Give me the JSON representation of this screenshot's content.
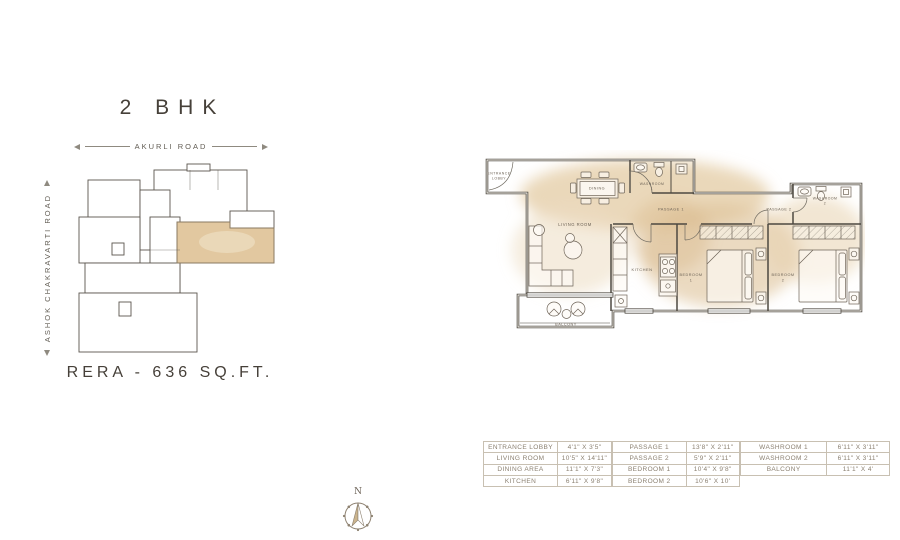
{
  "key_plan": {
    "title": "2 BHK",
    "road_top": "AKURLI ROAD",
    "road_left": "ASHOK CHAKRAVARTI ROAD",
    "rera_area": "RERA - 636 SQ.FT.",
    "highlight_color": "#e2c8a0"
  },
  "floor_plan": {
    "labels": {
      "entrance_lobby_1": "ENTRANCE",
      "entrance_lobby_2": "LOBBY",
      "dining": "DINING",
      "washroom1_name": "WASHROOM",
      "washroom1_num": "1",
      "passage1": "PASSAGE 1",
      "passage2": "PASSAGE 2",
      "washroom2_name": "WASHROOM",
      "washroom2_num": "2",
      "living_room": "LIVING ROOM",
      "kitchen": "KITCHEN",
      "bedroom1_name": "BEDROOM",
      "bedroom1_num": "1",
      "bedroom2_name": "BEDROOM",
      "bedroom2_num": "2",
      "balcony": "BALCONY"
    },
    "wash_color": "#e3cba3",
    "wall_color": "#4d4840"
  },
  "dimension_tables": [
    {
      "rows": [
        {
          "name": "ENTRANCE LOBBY",
          "size": "4'1\" X 3'5\""
        },
        {
          "name": "LIVING ROOM",
          "size": "10'5\" X 14'11\""
        },
        {
          "name": "DINING AREA",
          "size": "11'1\" X 7'3\""
        },
        {
          "name": "KITCHEN",
          "size": "6'11\" X 9'8\""
        }
      ]
    },
    {
      "rows": [
        {
          "name": "PASSAGE 1",
          "size": "13'8\" X 2'11\""
        },
        {
          "name": "PASSAGE 2",
          "size": "5'9\" X 2'11\""
        },
        {
          "name": "BEDROOM 1",
          "size": "10'4\" X 9'8\""
        },
        {
          "name": "BEDROOM 2",
          "size": "10'6\" X 10'"
        }
      ]
    },
    {
      "rows": [
        {
          "name": "WASHROOM 1",
          "size": "6'11\" X 3'11\""
        },
        {
          "name": "WASHROOM 2",
          "size": "6'11\" X 3'11\""
        },
        {
          "name": "BALCONY",
          "size": "11'1\" X 4'"
        }
      ]
    }
  ],
  "compass": {
    "north_label": "N"
  }
}
